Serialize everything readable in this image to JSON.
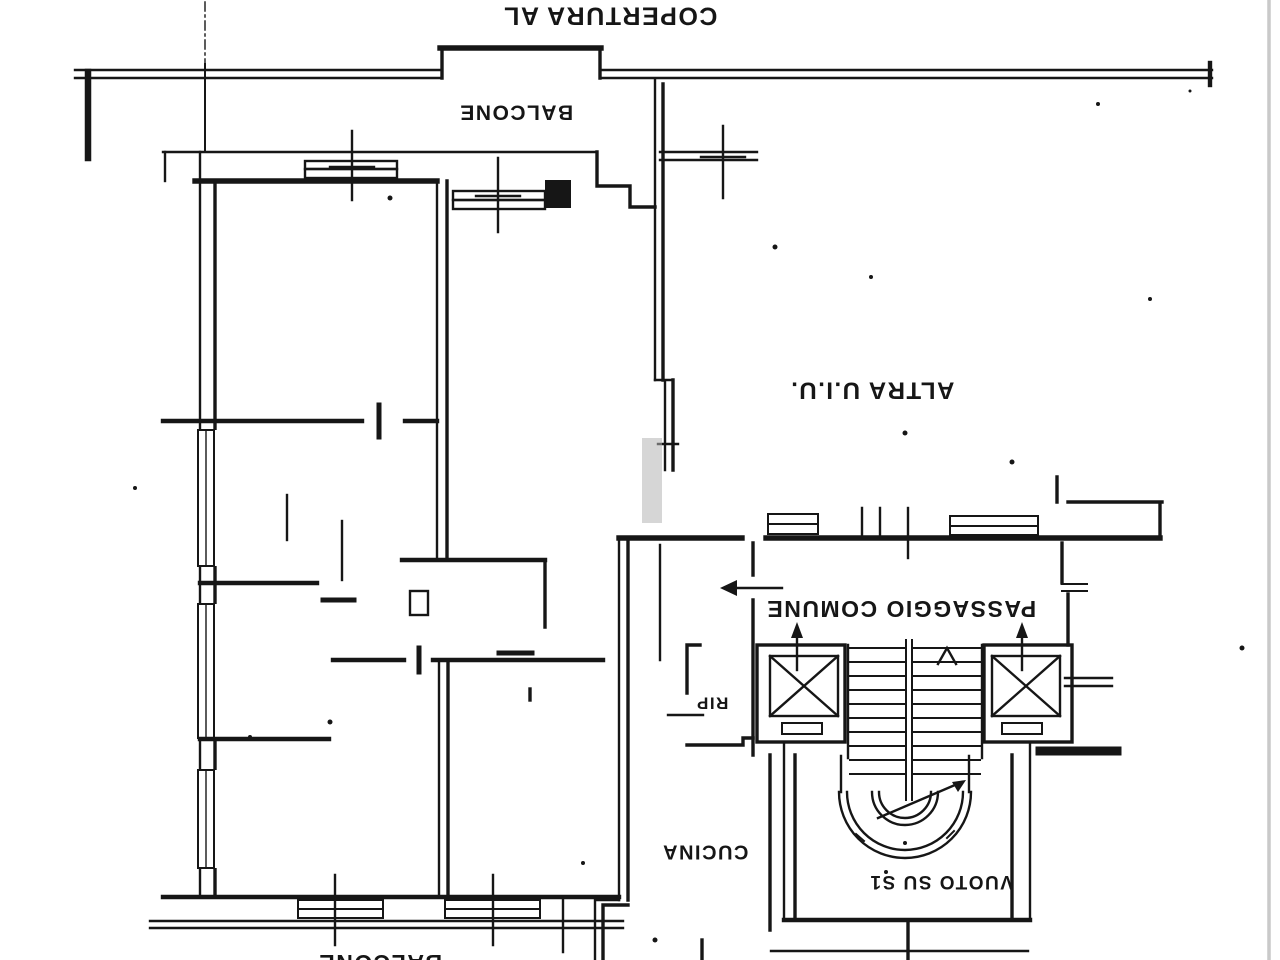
{
  "meta": {
    "kind": "scanned floor plan (planimetria catastale), drawing printed rotated 180°"
  },
  "colors": {
    "ink": "#161616",
    "paper": "#ffffff",
    "smudge": "#b5b5b5",
    "scan": "#c9c9c9"
  },
  "labels": {
    "coverage": "COPERTURA AL",
    "balcony_top": "BALCONE",
    "other_unit": "ALTRA U.I.U.",
    "common_passage": "PASSAGGIO COMUNE",
    "storage": "RIP",
    "kitchen": "CUCINA",
    "void_over_s1": "VUOTO SU S1",
    "balcony_bottom": "BALCONE"
  }
}
